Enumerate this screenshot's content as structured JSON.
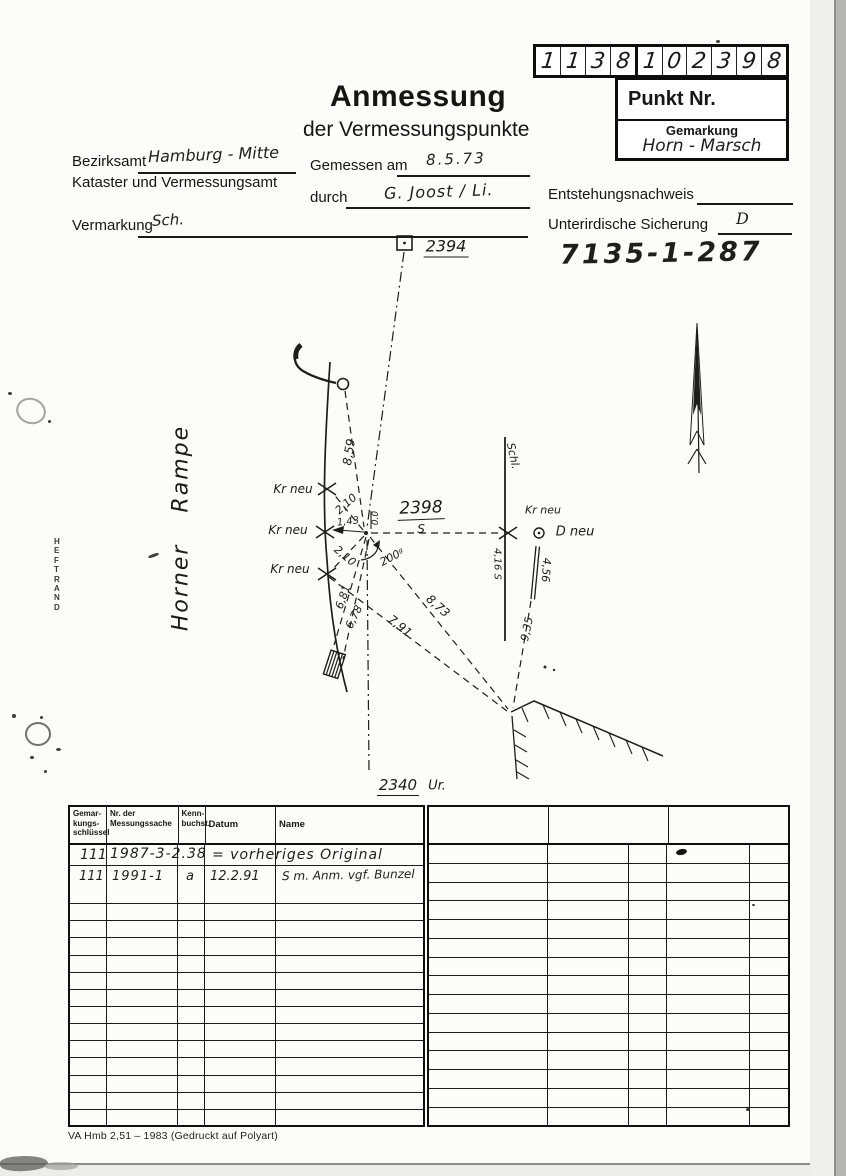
{
  "punkt": {
    "digits": [
      "1",
      "1",
      "3",
      "8",
      "1",
      "0",
      "2",
      "3",
      "9",
      "8"
    ],
    "punkt_label": "Punkt Nr.",
    "gemarkung_label": "Gemarkung",
    "gemarkung_value": "Horn - Marsch"
  },
  "header": {
    "title": "Anmessung",
    "subtitle": "der Vermessungspunkte"
  },
  "form": {
    "bezirksamt_label": "Bezirksamt",
    "bezirksamt_value": "Hamburg - Mitte",
    "amt_line2": "Kataster und Vermessungsamt",
    "gemessen_label": "Gemessen am",
    "gemessen_value": "8.5.73",
    "durch_label": "durch",
    "durch_value": "G. Joost / Li.",
    "entstehung_label": "Entstehungsnachweis",
    "vermarkung_label": "Vermarkung",
    "vermarkung_value": "Sch.",
    "sicherung_label": "Unterirdische Sicherung",
    "sicherung_value": "D",
    "ref_number": "7135-1-287"
  },
  "sketch": {
    "heftrand": "HEFTRAND",
    "annotations": [
      {
        "t": "2394",
        "x": 446,
        "y": 247,
        "r": 0,
        "s": 16,
        "u": 1
      },
      {
        "t": "2340",
        "x": 398,
        "y": 786,
        "r": 0,
        "s": 15,
        "u": 1
      },
      {
        "t": "Ur.",
        "x": 437,
        "y": 786,
        "r": 0,
        "s": 13
      },
      {
        "t": "2398",
        "x": 421,
        "y": 509,
        "r": -2,
        "s": 17,
        "u": 1
      },
      {
        "t": "S",
        "x": 421,
        "y": 529,
        "r": 0,
        "s": 12
      },
      {
        "t": "Kr neu",
        "x": 293,
        "y": 489,
        "r": 0,
        "s": 12
      },
      {
        "t": "Kr neu",
        "x": 288,
        "y": 530,
        "r": 0,
        "s": 12
      },
      {
        "t": "Kr neu",
        "x": 290,
        "y": 569,
        "r": 0,
        "s": 12
      },
      {
        "t": "Kr neu",
        "x": 543,
        "y": 510,
        "r": 0,
        "s": 11
      },
      {
        "t": "D neu",
        "x": 575,
        "y": 532,
        "r": 0,
        "s": 13
      },
      {
        "t": "Schl.",
        "x": 513,
        "y": 456,
        "r": 78,
        "s": 11
      },
      {
        "t": "8,59",
        "x": 349,
        "y": 452,
        "r": -81,
        "s": 12
      },
      {
        "t": "2,10",
        "x": 346,
        "y": 504,
        "r": -42,
        "s": 11
      },
      {
        "t": "1,43",
        "x": 348,
        "y": 522,
        "r": -6,
        "s": 10
      },
      {
        "t": "2,10",
        "x": 345,
        "y": 556,
        "r": 40,
        "s": 11
      },
      {
        "t": "0.0",
        "x": 376,
        "y": 518,
        "r": -90,
        "s": 9
      },
      {
        "t": "200ᵍ",
        "x": 392,
        "y": 557,
        "r": -28,
        "s": 11
      },
      {
        "t": "6,81",
        "x": 343,
        "y": 597,
        "r": -70,
        "s": 11
      },
      {
        "t": "6,78",
        "x": 354,
        "y": 617,
        "r": -64,
        "s": 11
      },
      {
        "t": "8,73",
        "x": 438,
        "y": 606,
        "r": 42,
        "s": 12
      },
      {
        "t": "7,91",
        "x": 400,
        "y": 626,
        "r": 39,
        "s": 12
      },
      {
        "t": "9,35",
        "x": 527,
        "y": 629,
        "r": -78,
        "s": 11
      },
      {
        "t": "4,16 S",
        "x": 497,
        "y": 564,
        "r": 90,
        "s": 10
      },
      {
        "t": "4,56",
        "x": 546,
        "y": 570,
        "r": 94,
        "s": 11
      },
      {
        "t": "Horner Rampe",
        "x": 181,
        "y": 528,
        "r": -90,
        "s": 22,
        "cls": "street"
      }
    ]
  },
  "table_left": {
    "headers": [
      "Gemar-\nkungs-\nschlüssel",
      "Nr. der\nMessungssache",
      "Kenn-\nbuchst.",
      "Datum",
      "Name"
    ],
    "row1": {
      "schluessel": "111",
      "sache": "1987-3-2.38",
      "rest": "= vorheriges  Original"
    },
    "row2": {
      "schluessel": "111",
      "sache": "1991-1",
      "kenn": "a",
      "datum": "12.2.91",
      "name": "S m. Anm. vgf. Bunzel"
    },
    "empty_rows": 14
  },
  "table_right": {
    "header_cols": 3,
    "body_rows": 15
  },
  "footer": "VA Hmb 2,51 – 1983 (Gedruckt auf Polyart)"
}
